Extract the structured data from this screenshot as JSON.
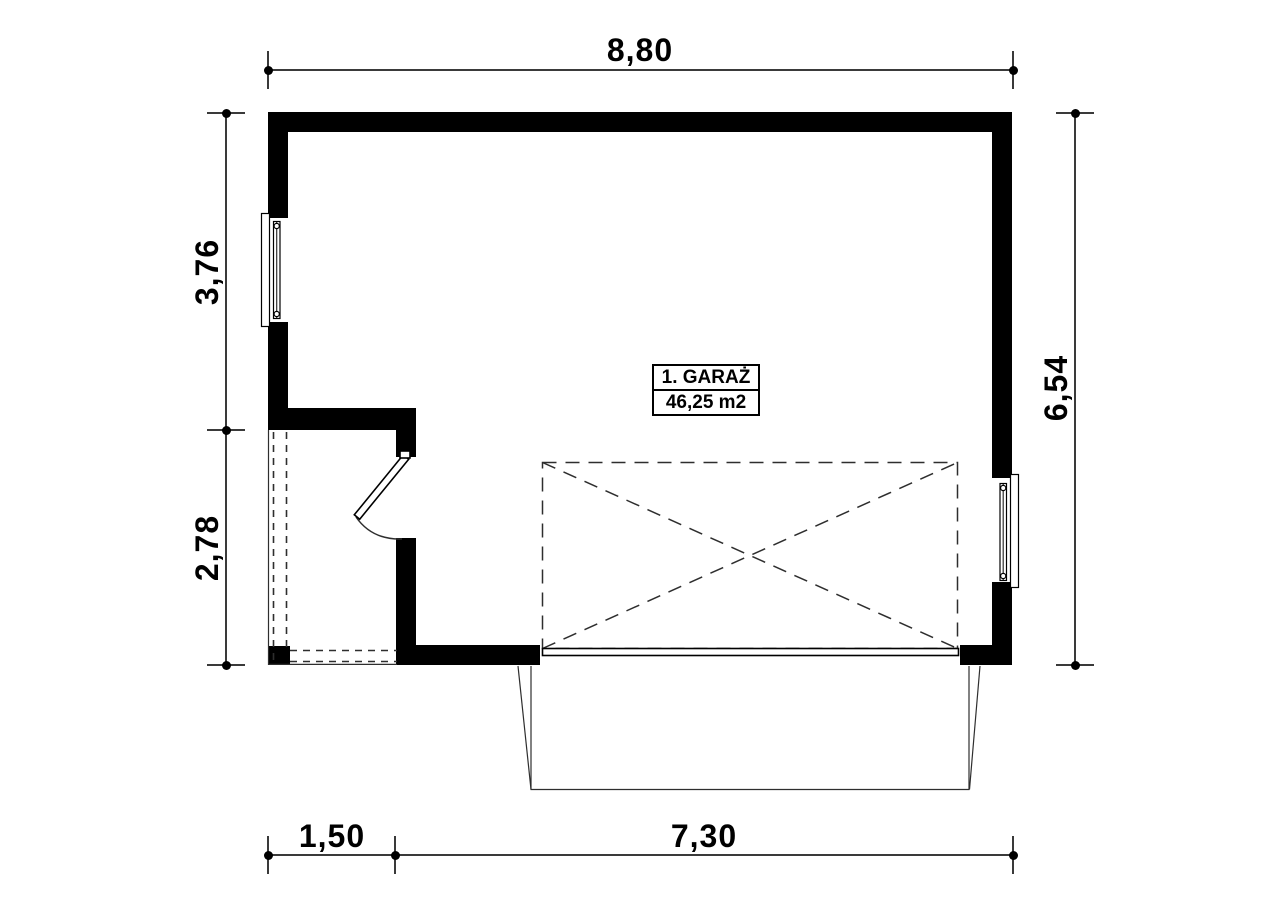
{
  "plan": {
    "room_label": {
      "name": "1. GARAŻ",
      "area": "46,25 m2"
    },
    "dimensions": {
      "top": "8,80",
      "left_upper": "3,76",
      "left_lower": "2,78",
      "right": "6,54",
      "bottom_left": "1,50",
      "bottom_right": "7,30"
    },
    "colors": {
      "wall": "#000000",
      "dimension_line": "#3a3a3a",
      "background": "#ffffff"
    }
  }
}
